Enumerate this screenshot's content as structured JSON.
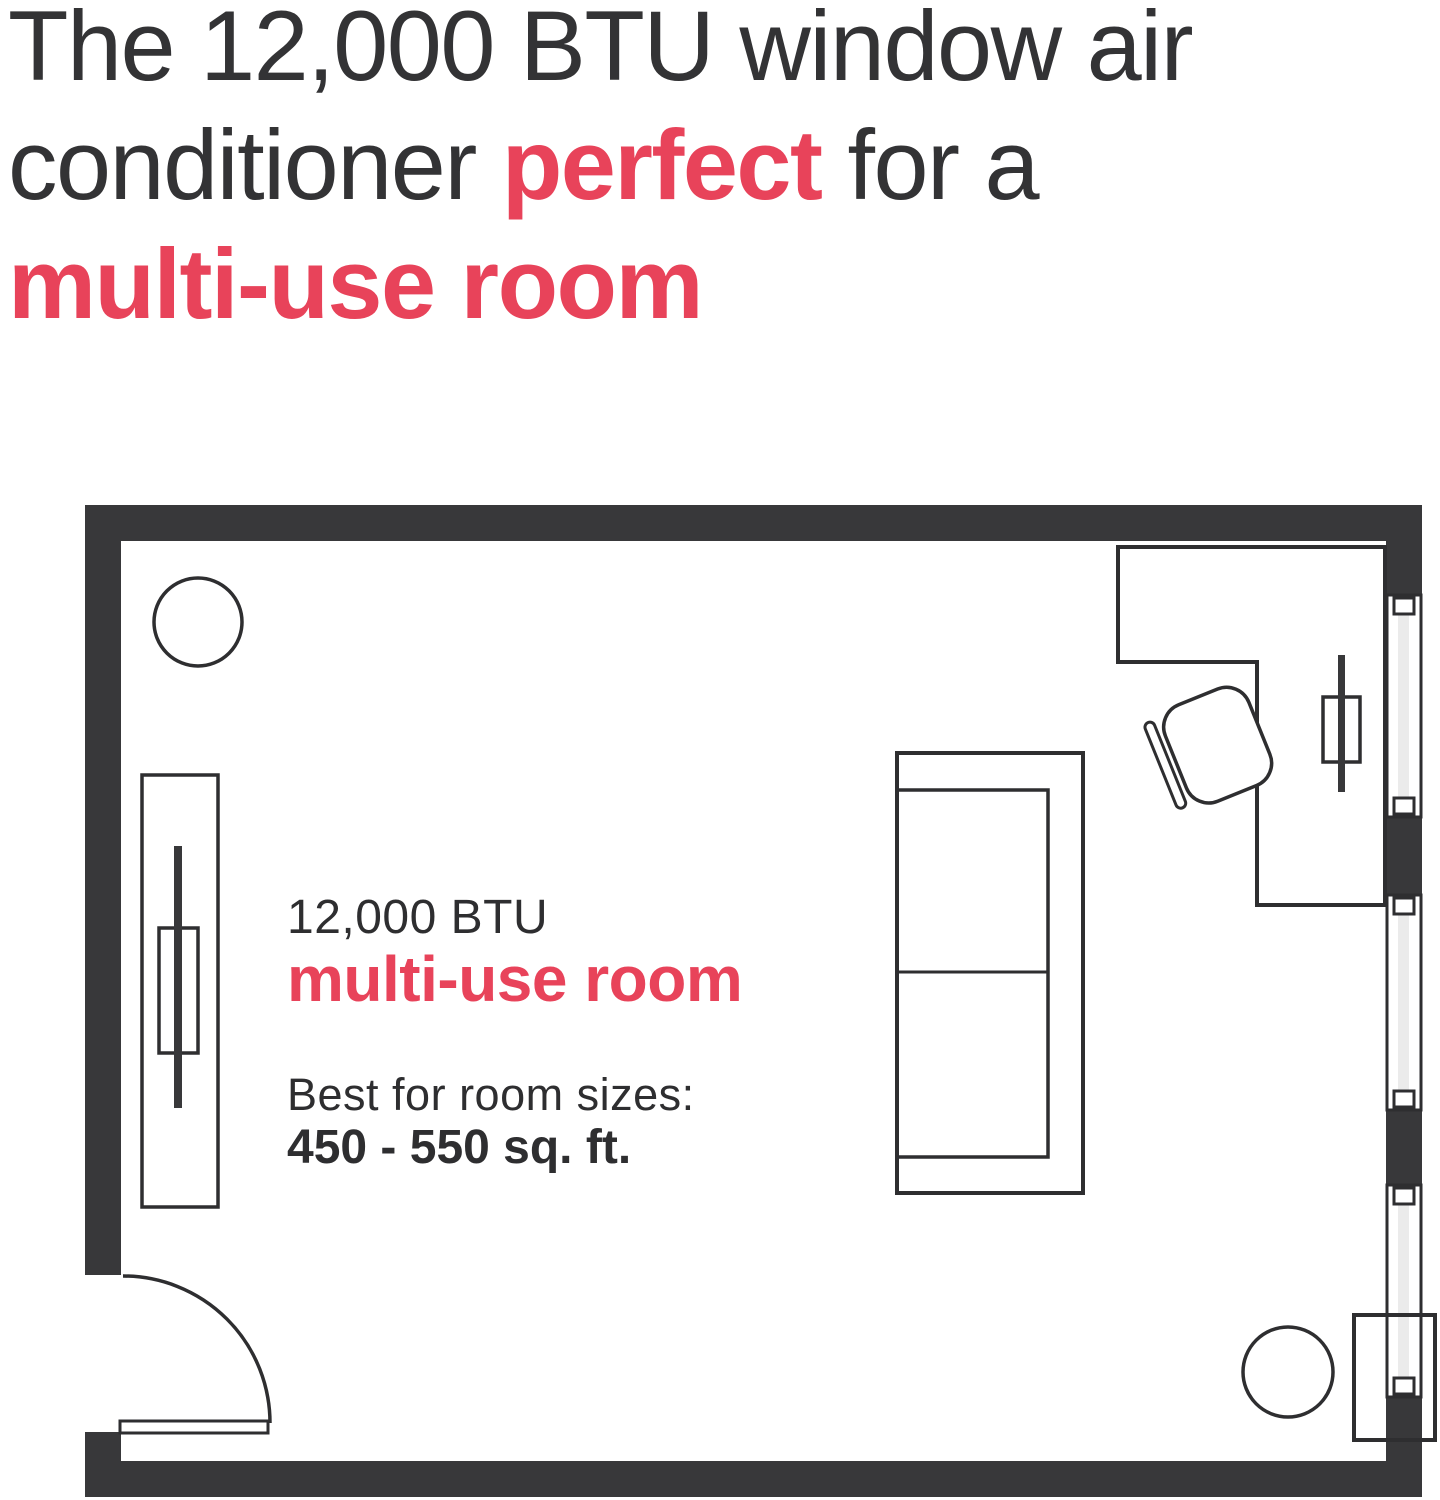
{
  "headline": {
    "line1": "The 12,000 BTU window air",
    "line2_pre": "conditioner ",
    "line2_red": "perfect",
    "line2_post": " for a",
    "line3": "multi-use room"
  },
  "floorplan": {
    "label_btu": "12,000 BTU",
    "label_room_type": "multi-use room",
    "label_best_for": "Best for room sizes:",
    "label_size_range": "450 - 550 sq. ft."
  },
  "colors": {
    "accent_red": "#e8435a",
    "text_dark": "#333335",
    "wall_dark": "#38383a",
    "outline_dark": "#2e2e30",
    "window_glass_gray": "#ebebeb"
  }
}
